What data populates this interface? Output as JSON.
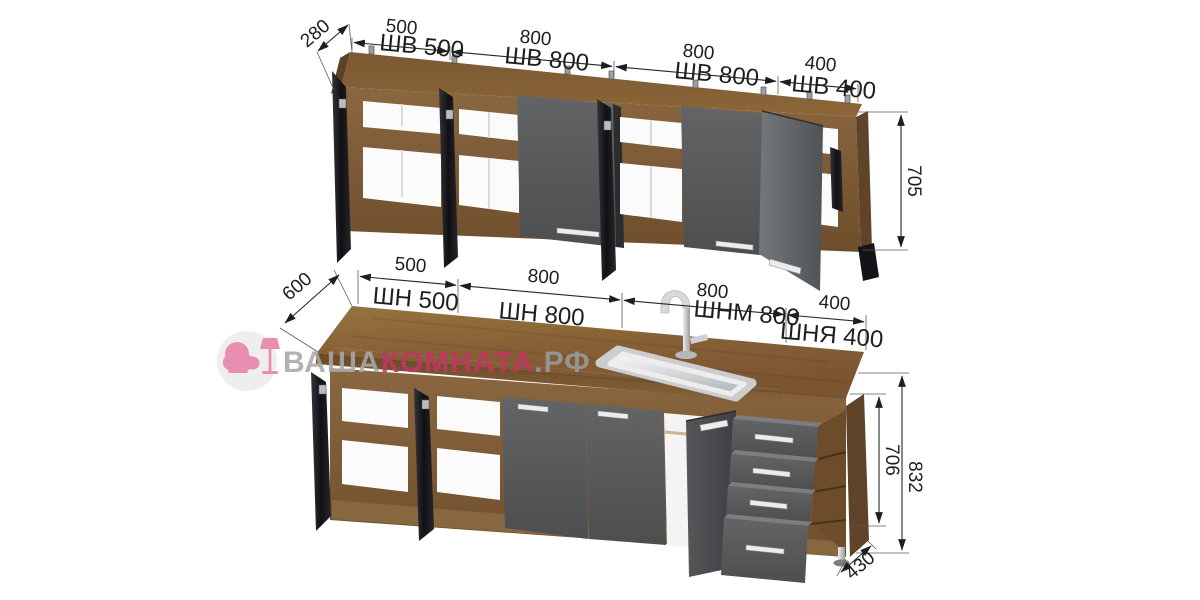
{
  "brand": {
    "part_gray_1": "ВАША",
    "part_pink": "КОМНАТА",
    "part_gray_2": ".РФ"
  },
  "wall_cabinets": {
    "depth": "280",
    "height": "705",
    "modules": [
      {
        "width": "500",
        "code": "ШВ 500"
      },
      {
        "width": "800",
        "code": "ШВ 800"
      },
      {
        "width": "800",
        "code": "ШВ 800"
      },
      {
        "width": "400",
        "code": "ШВ 400"
      }
    ]
  },
  "base_cabinets": {
    "depth": "600",
    "carcass_height": "706",
    "total_height": "832",
    "base_depth": "430",
    "modules": [
      {
        "width": "500",
        "code": "ШН 500"
      },
      {
        "width": "800",
        "code": "ШН 800"
      },
      {
        "width": "800",
        "code": "ШНМ 800"
      },
      {
        "width": "400",
        "code": "ШНЯ 400"
      }
    ]
  },
  "colors": {
    "wood": "#7d5a36",
    "countertop": "#8a6539",
    "door_gray": "#595b5d",
    "open_door_black": "#17171c",
    "accent_pink": "#c23663",
    "brand_gray": "#a8a8a8",
    "dim_line": "#272727"
  }
}
